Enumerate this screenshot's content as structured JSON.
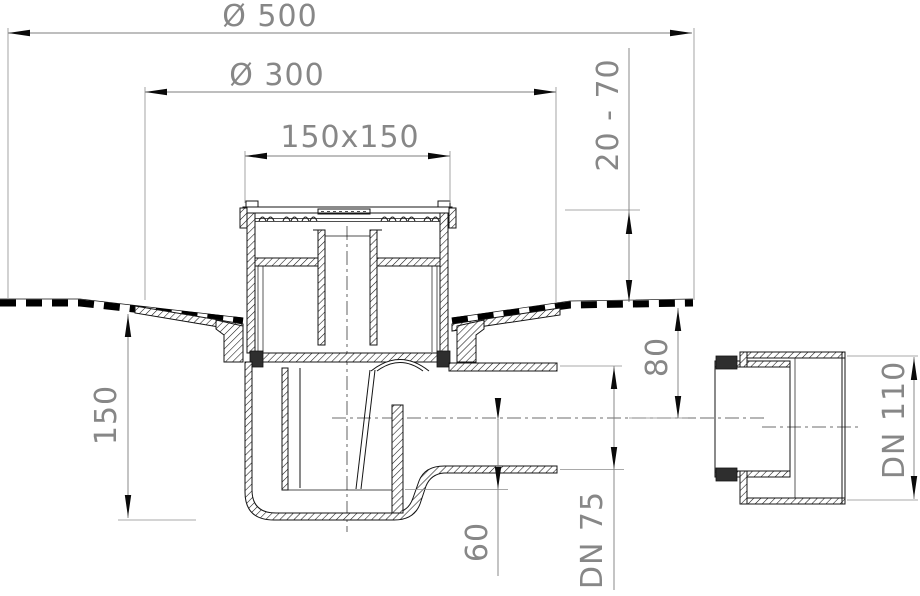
{
  "drawing": {
    "kind": "floor-drain cross-section technical drawing",
    "colors": {
      "outline": "#141414",
      "dimension": "#878787",
      "background": "#ffffff"
    },
    "dimensions": {
      "outer_diameter": {
        "label": "Ø 500"
      },
      "flange_diameter": {
        "label": "Ø 300"
      },
      "grate_size": {
        "label": "150x150"
      },
      "adjust_range": {
        "label": "20 - 70"
      },
      "body_height": {
        "label": "150"
      },
      "outlet_axis_drop": {
        "label": "80"
      },
      "invert_depth": {
        "label": "60"
      },
      "outlet_pipe": {
        "label": "DN 75"
      },
      "adapter_pipe": {
        "label": "DN 110"
      }
    }
  }
}
